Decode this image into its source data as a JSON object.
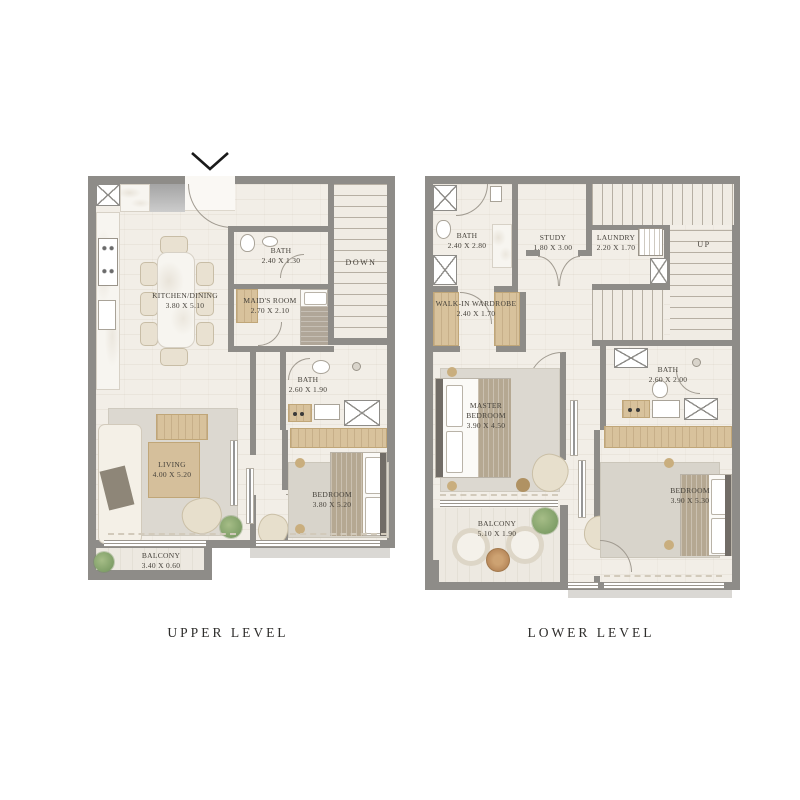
{
  "palette": {
    "wall": "#8e8c88",
    "floor": "#f2eee7",
    "balcony_floor": "#ede9e1",
    "wood": "#d8c29c",
    "label_text": "#45413a",
    "caption_text": "#2e2d2b",
    "entry_arrow": "#1a1a1a"
  },
  "upper": {
    "caption": "UPPER LEVEL",
    "stairs_label": "DOWN",
    "rooms": [
      {
        "name": "KITCHEN/DINING",
        "dims": "3.80 X 5.10"
      },
      {
        "name": "BATH",
        "dims": "2.40 X 1.30"
      },
      {
        "name": "MAID'S ROOM",
        "dims": "2.70 X 2.10"
      },
      {
        "name": "BATH",
        "dims": "2.60 X 1.90"
      },
      {
        "name": "LIVING",
        "dims": "4.00 X 5.20"
      },
      {
        "name": "BEDROOM",
        "dims": "3.80 X 5.20"
      },
      {
        "name": "BALCONY",
        "dims": "3.40 X 0.60"
      }
    ]
  },
  "lower": {
    "caption": "LOWER LEVEL",
    "stairs_label": "UP",
    "rooms": [
      {
        "name": "BATH",
        "dims": "2.40 X 2.80"
      },
      {
        "name": "STUDY",
        "dims": "1.80 X 3.00"
      },
      {
        "name": "LAUNDRY",
        "dims": "2.20 X 1.70"
      },
      {
        "name": "WALK-IN WARDROBE",
        "dims": "2.40 X 1.70"
      },
      {
        "name": "MASTER BEDROOM",
        "dims": "3.90 X 4.50"
      },
      {
        "name": "BATH",
        "dims": "2.60 X 2.00"
      },
      {
        "name": "BEDROOM",
        "dims": "3.90 X 5.30"
      },
      {
        "name": "BALCONY",
        "dims": "5.10 X 1.90"
      }
    ]
  }
}
